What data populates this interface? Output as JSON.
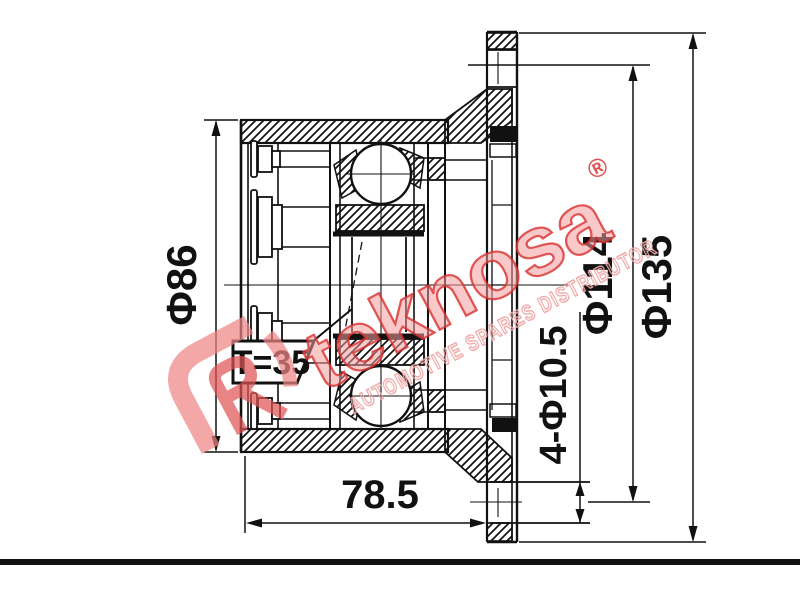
{
  "page": {
    "background": "#ffffff"
  },
  "drawing": {
    "line_color": "#111111",
    "dimensions": {
      "outer_diameter": "Φ86",
      "tooth_count": "T=35",
      "body_length": "78.5",
      "bolt_holes": "4-Φ10.5",
      "bolt_circle_diameter": "Φ114",
      "flange_diameter": "Φ135"
    }
  },
  "watermark": {
    "brand": "teknosa",
    "registered_symbol": "®",
    "tagline": "AUTOMOTIVE SPARES DISTRIBUTOR",
    "fill_color": "#f49d9d",
    "outline_color": "#d93030"
  }
}
